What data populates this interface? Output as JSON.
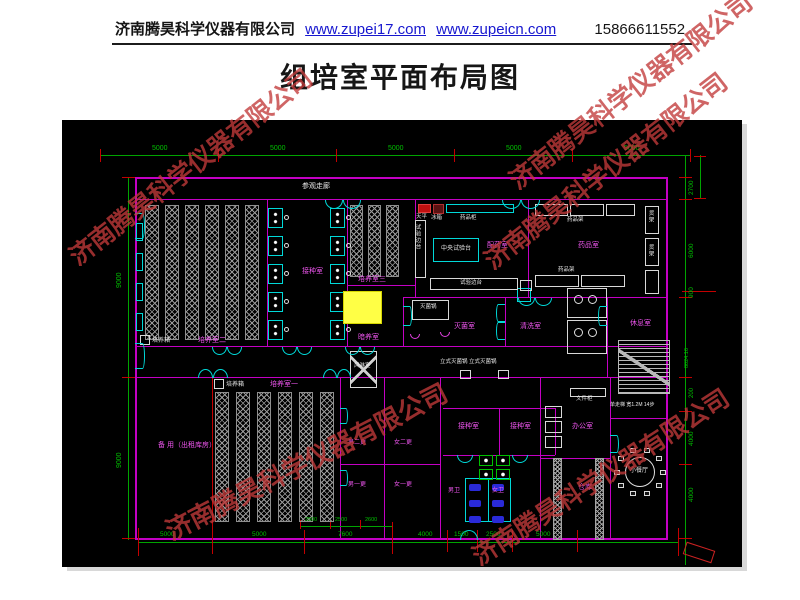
{
  "header": {
    "company": "济南腾昊科学仪器有限公司",
    "url1": "www.zupei17.com",
    "url2": "www.zupeicn.com",
    "phone": "15866611552"
  },
  "title": "组培室平面布局图",
  "watermark": {
    "text": "济南腾昊科学仪器有限公司",
    "color": "#c23a3a"
  },
  "plan": {
    "background": "#000000",
    "colors": {
      "wall": "#c400c4",
      "dimension": "#00a400",
      "tick": "#c40000",
      "label": "#ee55ee",
      "equipment_text": "#e8e8e8",
      "door": "#00d8d8",
      "highlight": "#ffff45"
    },
    "labels": [
      {
        "t": "参观走廊",
        "x": 240,
        "y": 63,
        "c": "w",
        "s": 7
      },
      {
        "t": "培养箱",
        "x": 90,
        "y": 218,
        "c": "w",
        "s": 6
      },
      {
        "t": "培养室二",
        "x": 136,
        "y": 217,
        "c": "m",
        "s": 7
      },
      {
        "t": "接种室",
        "x": 240,
        "y": 148,
        "c": "m",
        "s": 7
      },
      {
        "t": "培养室三",
        "x": 296,
        "y": 156,
        "c": "m",
        "s": 7
      },
      {
        "t": "暗养室",
        "x": 296,
        "y": 214,
        "c": "m",
        "s": 7
      },
      {
        "t": "天平",
        "x": 354,
        "y": 95,
        "c": "w",
        "s": 5.5
      },
      {
        "t": "冰箱",
        "x": 369,
        "y": 96,
        "c": "w",
        "s": 5.5
      },
      {
        "t": "药品柜",
        "x": 398,
        "y": 96,
        "c": "w",
        "s": 5.5
      },
      {
        "t": "中央试验台",
        "x": 379,
        "y": 126,
        "c": "w",
        "s": 6
      },
      {
        "t": "试验边台",
        "x": 352,
        "y": 104,
        "c": "w",
        "s": 5.5,
        "v": 1
      },
      {
        "t": "试验边台",
        "x": 398,
        "y": 161,
        "c": "w",
        "s": 5.5
      },
      {
        "t": "配药室",
        "x": 425,
        "y": 122,
        "c": "m",
        "s": 7
      },
      {
        "t": "药品架",
        "x": 505,
        "y": 98,
        "c": "w",
        "s": 5.5
      },
      {
        "t": "药品室",
        "x": 516,
        "y": 122,
        "c": "m",
        "s": 7
      },
      {
        "t": "药品架",
        "x": 496,
        "y": 148,
        "c": "w",
        "s": 5.5
      },
      {
        "t": "货架",
        "x": 585,
        "y": 90,
        "c": "w",
        "s": 5.5,
        "v": 1
      },
      {
        "t": "货架",
        "x": 585,
        "y": 124,
        "c": "w",
        "s": 5.5,
        "v": 1
      },
      {
        "t": "灭菌锅",
        "x": 358,
        "y": 185,
        "c": "w",
        "s": 5.5
      },
      {
        "t": "灭菌室",
        "x": 392,
        "y": 203,
        "c": "m",
        "s": 7
      },
      {
        "t": "清洗室",
        "x": 458,
        "y": 203,
        "c": "m",
        "s": 7
      },
      {
        "t": "休息室",
        "x": 568,
        "y": 200,
        "c": "m",
        "s": 7
      },
      {
        "t": "立式灭菌锅 立式灭菌锅",
        "x": 378,
        "y": 240,
        "c": "w",
        "s": 5.5
      },
      {
        "t": "风淋室",
        "x": 292,
        "y": 244,
        "c": "w",
        "s": 5.5
      },
      {
        "t": "培养箱",
        "x": 164,
        "y": 262,
        "c": "w",
        "s": 6
      },
      {
        "t": "培养室一",
        "x": 208,
        "y": 261,
        "c": "m",
        "s": 7
      },
      {
        "t": "备 用（出租库房）",
        "x": 96,
        "y": 322,
        "c": "m",
        "s": 7
      },
      {
        "t": "男二更",
        "x": 286,
        "y": 320,
        "c": "m",
        "s": 6
      },
      {
        "t": "女二更",
        "x": 332,
        "y": 320,
        "c": "m",
        "s": 6
      },
      {
        "t": "男一更",
        "x": 286,
        "y": 362,
        "c": "m",
        "s": 6
      },
      {
        "t": "女一更",
        "x": 332,
        "y": 362,
        "c": "m",
        "s": 6
      },
      {
        "t": "接种室",
        "x": 396,
        "y": 303,
        "c": "m",
        "s": 7
      },
      {
        "t": "接种室",
        "x": 448,
        "y": 303,
        "c": "m",
        "s": 7
      },
      {
        "t": "男卫",
        "x": 386,
        "y": 368,
        "c": "m",
        "s": 6
      },
      {
        "t": "女卫",
        "x": 430,
        "y": 368,
        "c": "m",
        "s": 6
      },
      {
        "t": "办公室",
        "x": 510,
        "y": 303,
        "c": "m",
        "s": 7
      },
      {
        "t": "文件柜",
        "x": 514,
        "y": 277,
        "c": "w",
        "s": 5.5
      },
      {
        "t": "仓库",
        "x": 516,
        "y": 364,
        "c": "m",
        "s": 7
      },
      {
        "t": "小餐厅",
        "x": 568,
        "y": 348,
        "c": "w",
        "s": 6
      },
      {
        "t": "单走梯 宽1.2M 14步",
        "x": 548,
        "y": 283,
        "c": "w",
        "s": 5
      },
      {
        "t": "5000",
        "x": 90,
        "y": 25,
        "c": "g",
        "s": 7
      },
      {
        "t": "5000",
        "x": 208,
        "y": 25,
        "c": "g",
        "s": 7
      },
      {
        "t": "5000",
        "x": 326,
        "y": 25,
        "c": "g",
        "s": 7
      },
      {
        "t": "5000",
        "x": 444,
        "y": 25,
        "c": "g",
        "s": 7
      },
      {
        "t": "5000",
        "x": 562,
        "y": 25,
        "c": "g",
        "s": 7
      },
      {
        "t": "9000",
        "x": 54,
        "y": 168,
        "c": "g",
        "s": 7,
        "r": -90
      },
      {
        "t": "9000",
        "x": 54,
        "y": 348,
        "c": "g",
        "s": 7,
        "r": -90
      },
      {
        "t": "2700",
        "x": 627,
        "y": 75,
        "c": "g",
        "s": 6.5,
        "r": -90
      },
      {
        "t": "6000",
        "x": 627,
        "y": 138,
        "c": "g",
        "s": 6.5,
        "r": -90
      },
      {
        "t": "900",
        "x": 627,
        "y": 178,
        "c": "g",
        "s": 6.5,
        "r": -90
      },
      {
        "t": "8024.16",
        "x": 623,
        "y": 248,
        "c": "g",
        "s": 5.5,
        "r": -90
      },
      {
        "t": "200",
        "x": 627,
        "y": 278,
        "c": "g",
        "s": 6,
        "r": -90
      },
      {
        "t": "4000",
        "x": 627,
        "y": 326,
        "c": "g",
        "s": 6.5,
        "r": -90
      },
      {
        "t": "4000",
        "x": 627,
        "y": 382,
        "c": "g",
        "s": 6.5,
        "r": -90
      },
      {
        "t": "5000",
        "x": 98,
        "y": 412,
        "c": "g",
        "s": 6.5
      },
      {
        "t": "5000",
        "x": 190,
        "y": 412,
        "c": "g",
        "s": 6.5
      },
      {
        "t": "7600",
        "x": 276,
        "y": 412,
        "c": "g",
        "s": 6.5
      },
      {
        "t": "4000",
        "x": 356,
        "y": 412,
        "c": "g",
        "s": 6.5
      },
      {
        "t": "1500",
        "x": 392,
        "y": 412,
        "c": "g",
        "s": 6.5
      },
      {
        "t": "2500",
        "x": 424,
        "y": 412,
        "c": "g",
        "s": 6.5
      },
      {
        "t": "5000",
        "x": 474,
        "y": 412,
        "c": "g",
        "s": 6.5
      },
      {
        "t": "2500",
        "x": 243,
        "y": 398,
        "c": "g",
        "s": 5.5
      },
      {
        "t": "2500",
        "x": 273,
        "y": 398,
        "c": "g",
        "s": 5.5
      },
      {
        "t": "2600",
        "x": 303,
        "y": 398,
        "c": "g",
        "s": 5.5
      }
    ]
  }
}
